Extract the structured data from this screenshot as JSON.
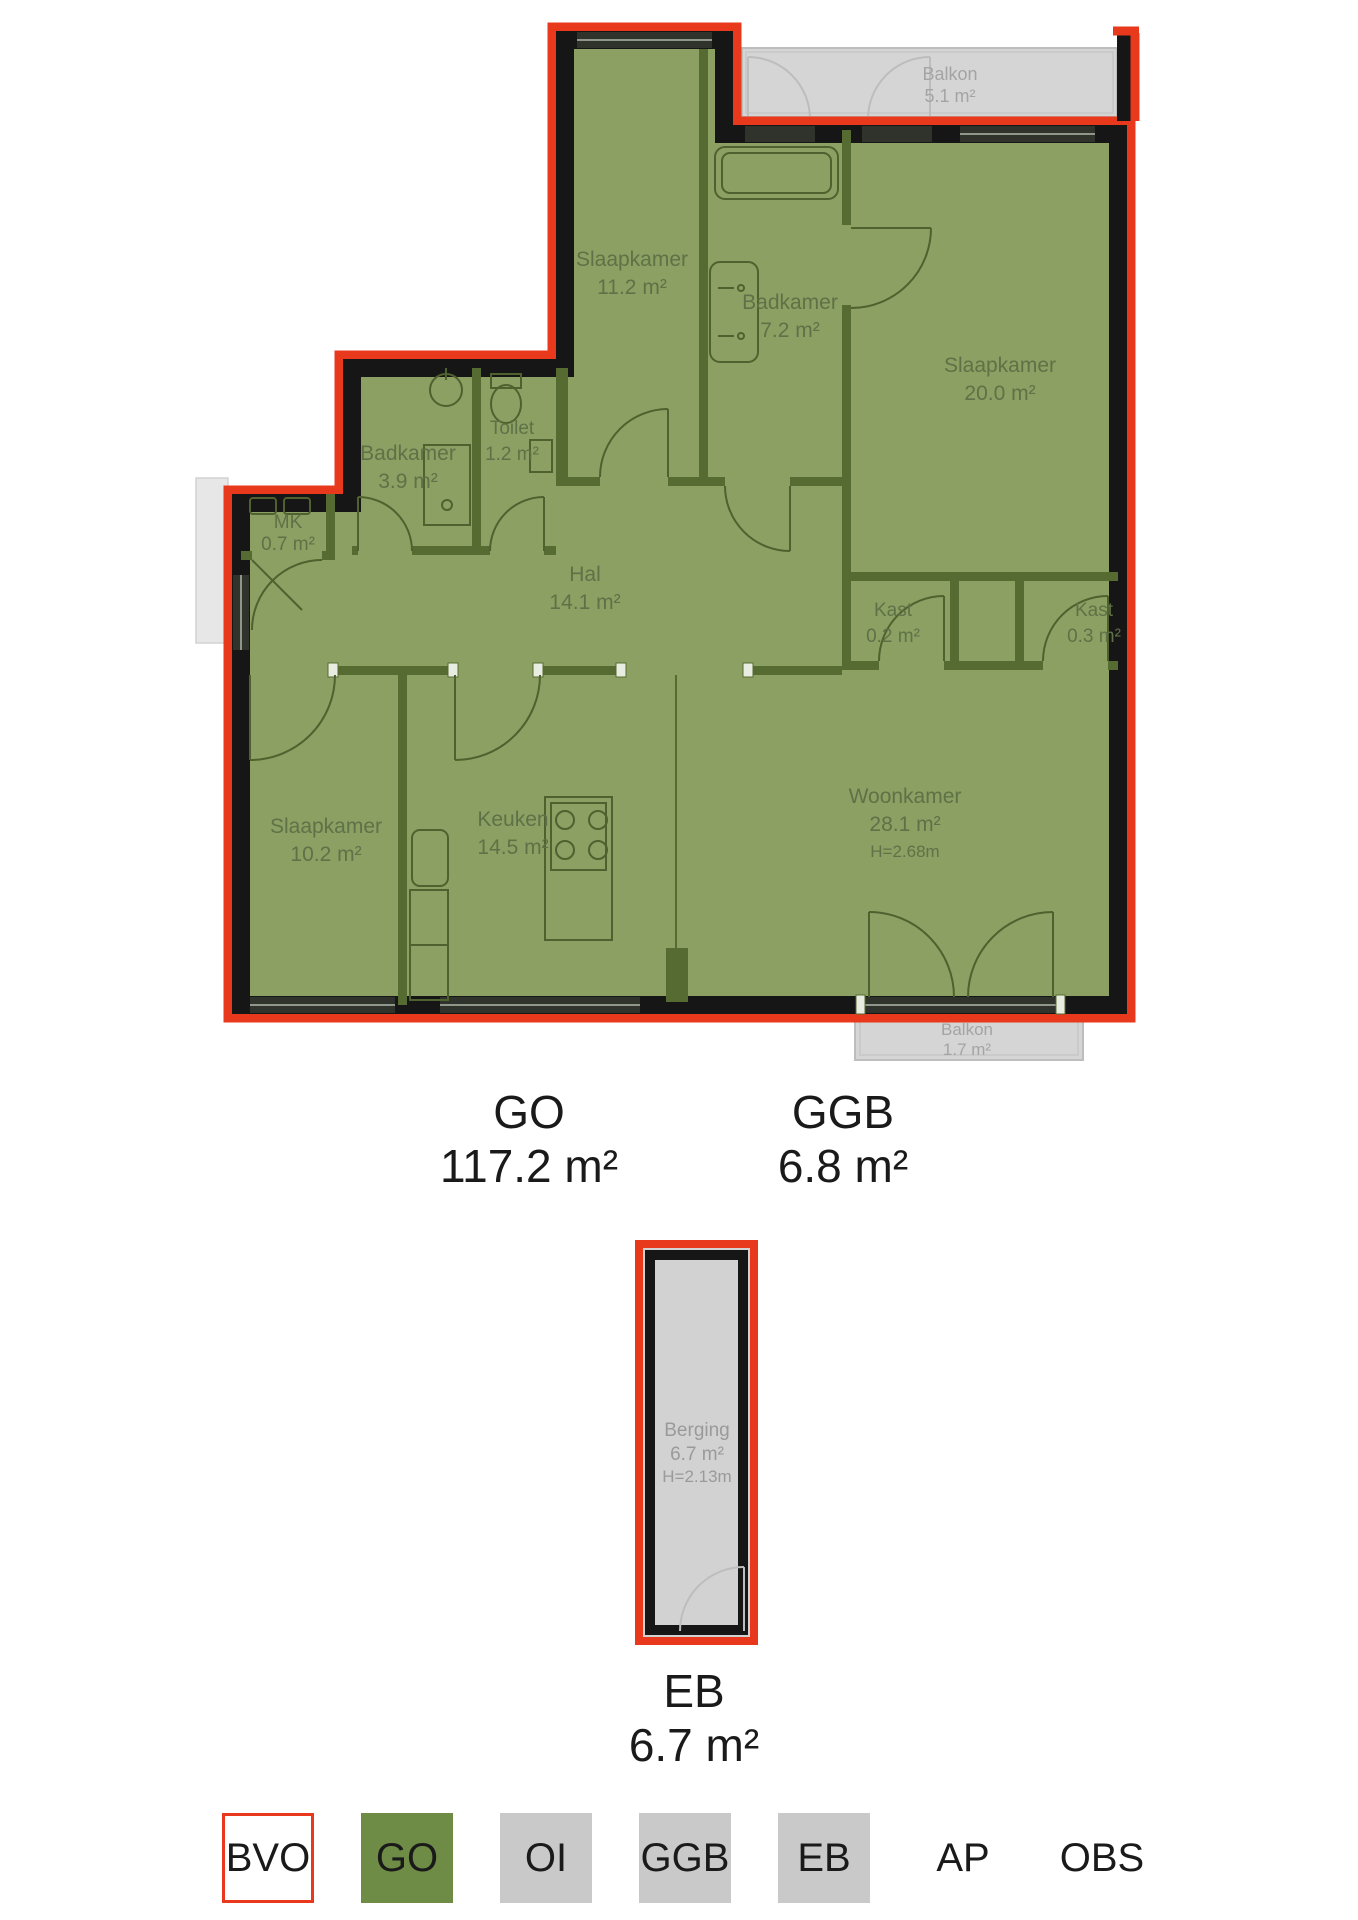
{
  "colors": {
    "bvo_red": "#e8391d",
    "plan_green": "#8ca063",
    "wall_black": "#161616",
    "interior_wall": "#566b31",
    "fixture_line": "#4f612e",
    "room_label": "#5f7147",
    "balcony_fill": "#d5d5d5",
    "balcony_line": "#bdbdbd",
    "balcony_label": "#a4a4a4",
    "window_dark": "#2f332b",
    "window_line": "#8f968a",
    "legend_green": "#6f8c46",
    "legend_gray": "#c9c9c9",
    "berging_fill": "#d2d2d2",
    "berging_label": "#9a9a9a",
    "text_black": "#1a1a1a"
  },
  "floorplan": {
    "rooms": [
      {
        "name": "Slaapkamer",
        "area": "11.2 m²"
      },
      {
        "name": "Badkamer",
        "area": "7.2 m²"
      },
      {
        "name": "Slaapkamer",
        "area": "20.0 m²"
      },
      {
        "name": "Toilet",
        "area": "1.2 m²"
      },
      {
        "name": "Badkamer",
        "area": "3.9 m²"
      },
      {
        "name": "MK",
        "area": "0.7 m²"
      },
      {
        "name": "Hal",
        "area": "14.1 m²"
      },
      {
        "name": "Kast",
        "area": "0.2 m²"
      },
      {
        "name": "Kast",
        "area": "0.3 m²"
      },
      {
        "name": "Slaapkamer",
        "area": "10.2 m²"
      },
      {
        "name": "Keuken",
        "area": "14.5 m²"
      },
      {
        "name": "Woonkamer",
        "area": "28.1 m²",
        "height": "H=2.68m"
      },
      {
        "name": "Balkon",
        "area": "5.1 m²"
      },
      {
        "name": "Balkon",
        "area": "1.7 m²"
      }
    ],
    "storage": {
      "name": "Berging",
      "area": "6.7 m²",
      "height": "H=2.13m"
    },
    "summaries": {
      "go": {
        "label": "GO",
        "value": "117.2 m²"
      },
      "ggb": {
        "label": "GGB",
        "value": "6.8 m²"
      },
      "eb": {
        "label": "EB",
        "value": "6.7 m²"
      }
    }
  },
  "legend": {
    "items": [
      {
        "label": "BVO"
      },
      {
        "label": "GO"
      },
      {
        "label": "OI"
      },
      {
        "label": "GGB"
      },
      {
        "label": "EB"
      },
      {
        "label": "AP"
      },
      {
        "label": "OBS"
      }
    ]
  }
}
